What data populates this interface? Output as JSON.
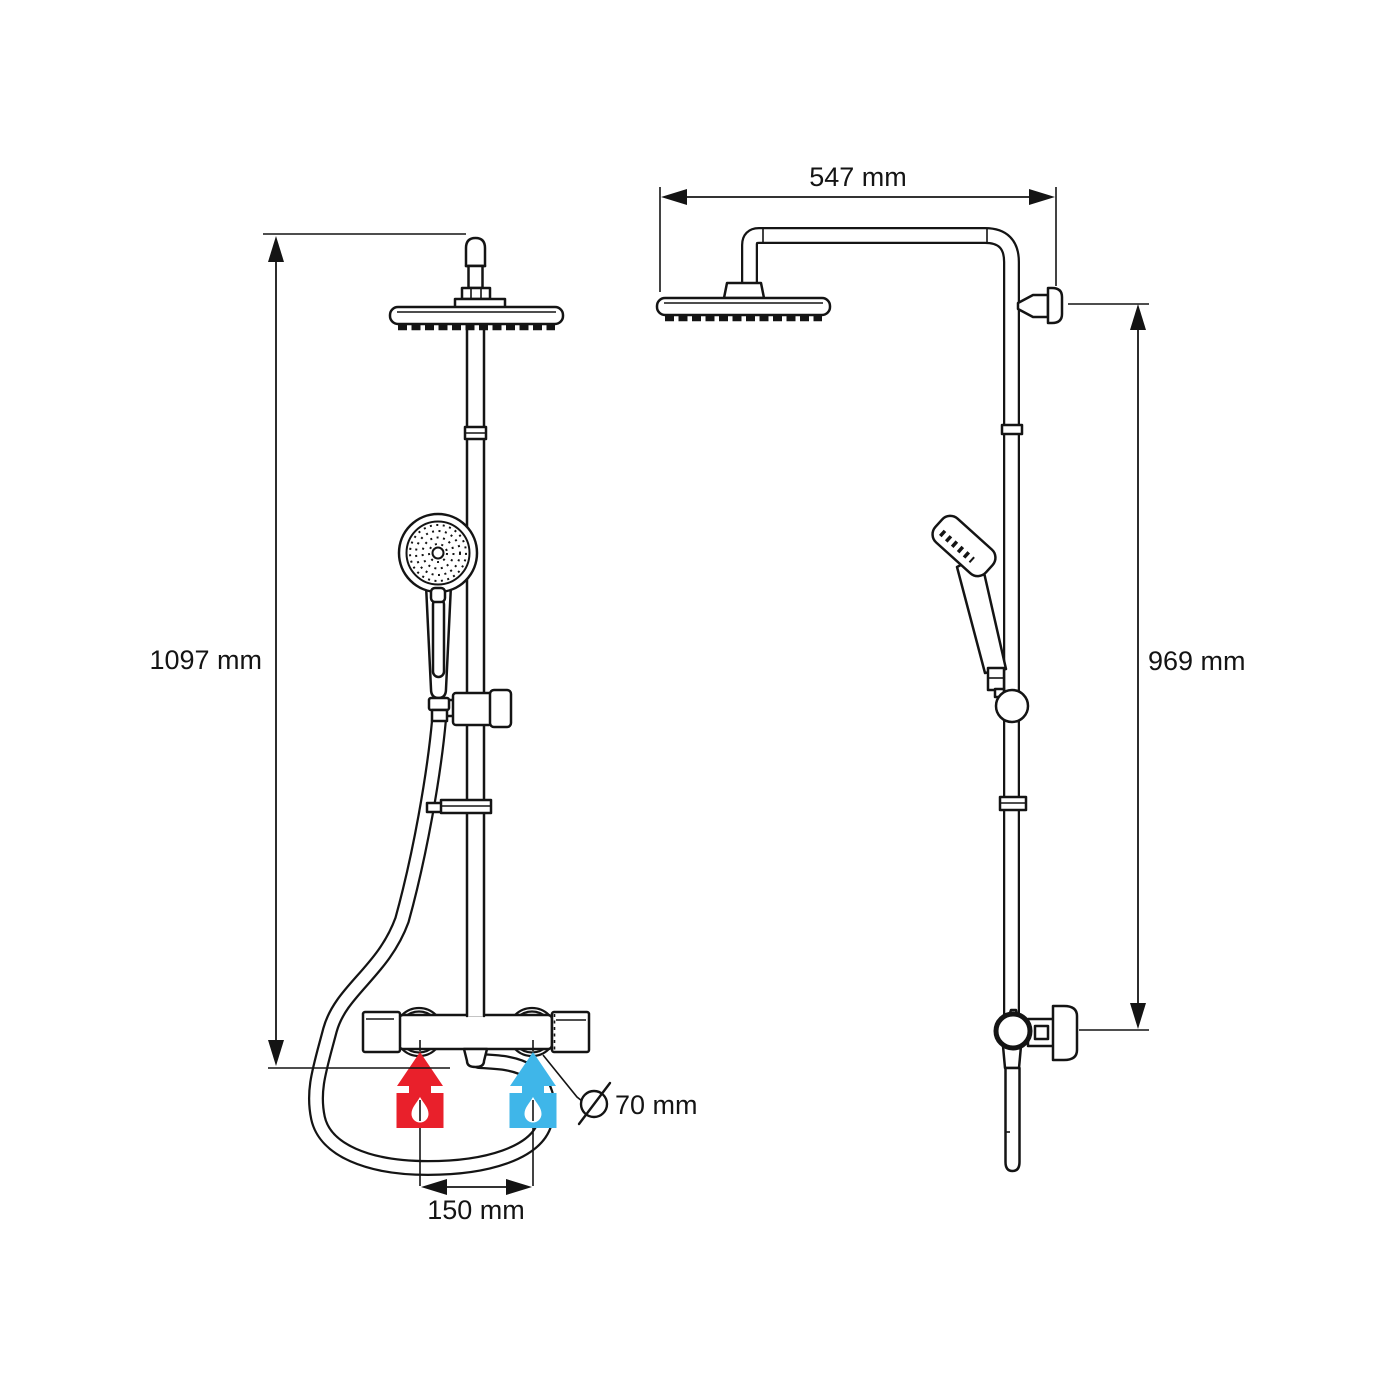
{
  "front_view": {
    "height_dimension_label": "1097 mm",
    "inlet_spacing_label": "150 mm",
    "inlet_diameter_label": "70 mm",
    "hot_inlet_color": "#e9202b",
    "cold_inlet_color": "#3fb6e9"
  },
  "side_view": {
    "reach_dimension_label": "547 mm",
    "bracket_height_label": "969 mm"
  },
  "icons": {
    "diameter_symbol": "Ø",
    "water_drop": "droplet",
    "flow_direction": "up-arrow"
  },
  "colors": {
    "line": "#141414",
    "background": "#ffffff",
    "slider_knob_gray": "#b9b9b9"
  }
}
